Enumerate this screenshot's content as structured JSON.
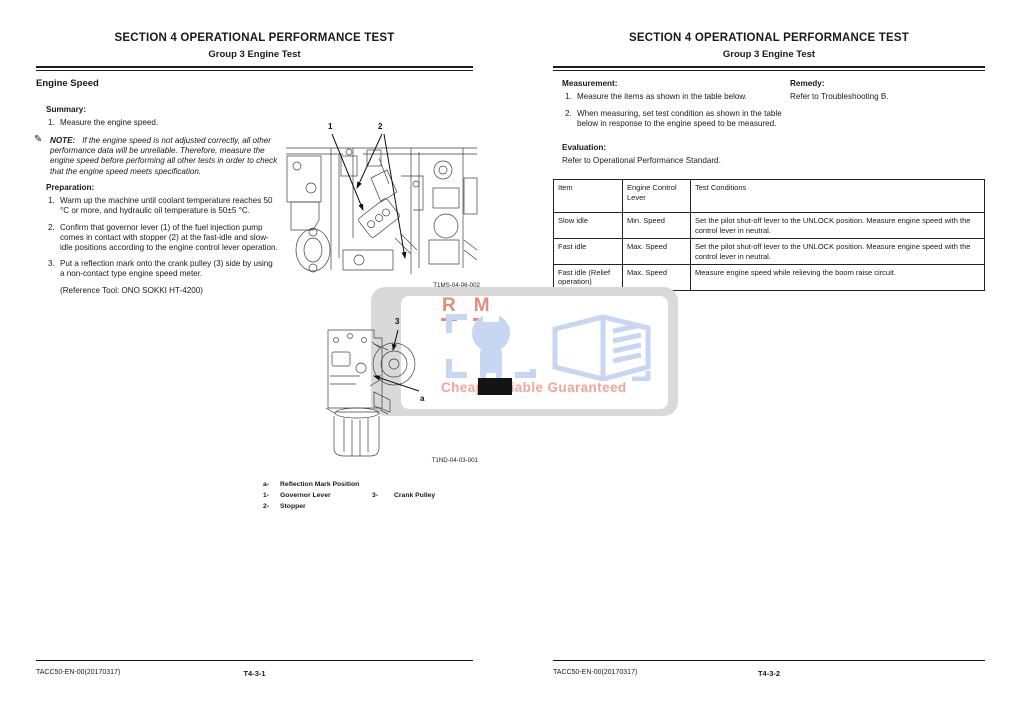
{
  "document": {
    "title": "SECTION 4 OPERATIONAL PERFORMANCE TEST",
    "subtitle": "Group 3 Engine Test",
    "doc_code": "TACC50-EN-00(20170317)"
  },
  "left_page": {
    "heading": "Engine Speed",
    "summary_label": "Summary:",
    "summary_item_num": "1.",
    "summary_item": "Measure the engine speed.",
    "note_icon_glyph": "✎",
    "note_label": "NOTE:",
    "note_text": "If the engine speed is not adjusted correctly, all other performance data will be unreliable. Therefore, measure the engine speed before performing all other tests in order to check that the engine speed meets specification.",
    "preparation_label": "Preparation:",
    "preparation_items": [
      {
        "num": "1.",
        "text": "Warm up the machine until coolant temperature reaches 50 °C or more, and hydraulic oil temperature is 50±5 °C."
      },
      {
        "num": "2.",
        "text": "Confirm that governor lever (1) of the fuel injection pump comes in contact with stopper (2) at the fast-idle and slow-idle positions according to the engine control lever operation."
      },
      {
        "num": "3.",
        "text": "Put a reflection mark onto the crank pulley (3) side by using a non-contact type engine speed meter."
      }
    ],
    "reference_tool": "(Reference Tool: ONO SOKKI HT-4200)",
    "figure1": {
      "caption": "T1MS-04-06-002",
      "callout1": "1",
      "callout2": "2"
    },
    "figure2": {
      "caption": "T1ND-04-03-001",
      "callout3": "3",
      "callout_a": "a"
    },
    "legend": {
      "a_key": "a-",
      "a_label": "Reflection Mark Position",
      "k1": "1-",
      "v1": "Governor Lever",
      "k2": "2-",
      "v2": "Stopper",
      "k3": "3-",
      "v3": "Crank Pulley"
    },
    "page_number": "T4-3-1"
  },
  "right_page": {
    "measurement_label": "Measurement:",
    "measurement_items": [
      {
        "num": "1.",
        "text": "Measure the items as shown in the table below."
      },
      {
        "num": "2.",
        "text": "When measuring, set test condition as shown in the table below in response to the engine speed to be measured."
      }
    ],
    "remedy_label": "Remedy:",
    "remedy_text": "Refer to Troubleshooting B.",
    "evaluation_label": "Evaluation:",
    "evaluation_text": "Refer to Operational Performance Standard.",
    "table": {
      "headers": [
        "Item",
        "Engine Control Lever",
        "Test Conditions"
      ],
      "rows": [
        [
          "Slow idle",
          "Min. Speed",
          "Set the pilot shut-off lever to the UNLOCK position. Measure engine speed with the control lever in neutral."
        ],
        [
          "Fast idle",
          "Max. Speed",
          "Set the pilot shut-off lever to the UNLOCK position. Measure engine speed with the control lever in neutral."
        ],
        [
          "Fast idle (Relief operation)",
          "Max. Speed",
          "Measure engine speed while relieving the boom raise circuit."
        ]
      ]
    },
    "page_number": "T4-3-2"
  },
  "watermark": {
    "letter_r": "R",
    "letter_m": "M",
    "tagline": "Cheap Reliable Guaranteed",
    "colors": {
      "salmon": "#ea8a7e",
      "light_blue": "#c7d6f2",
      "grey": "#d9d9d9"
    }
  }
}
